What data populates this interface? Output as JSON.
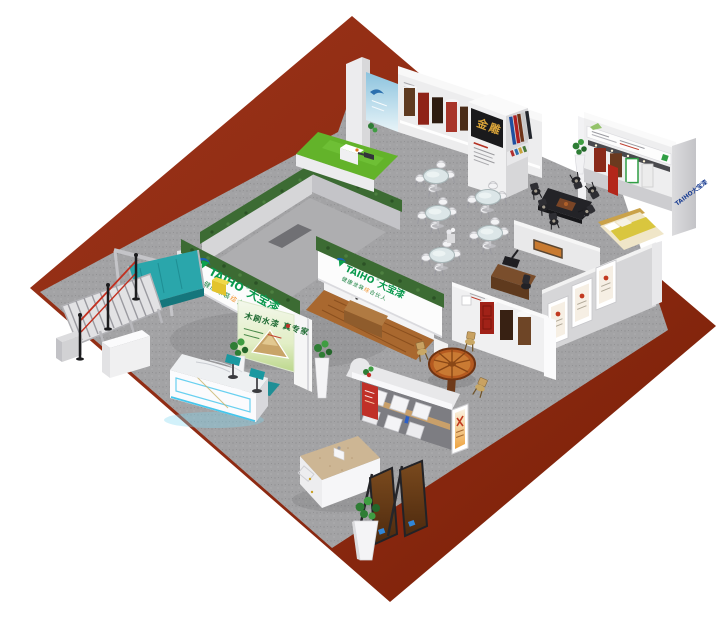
{
  "scene": {
    "type": "3d-exhibition-booth-render",
    "background": "#ffffff"
  },
  "colors": {
    "platform_maroon": "#8e2a12",
    "carpet_gray": "#a3a3a5",
    "hedge_green": "#3c6b33",
    "grass_green": "#63b32a",
    "belt_teal": "#2aa6ab",
    "brand_green": "#0a9a4e",
    "brand_blue": "#1c3f93",
    "sign_gold": "#d9a43a"
  },
  "branding": {
    "logo_en": "TAIHO",
    "logo_reg": "®",
    "logo_cn": "大宝漆",
    "slogan_prefix": "健康涂装",
    "slogan_accent": "综",
    "slogan_suffix": "合伙人",
    "poster_calligraphy": "木刷水漆 真专家",
    "gold_sign": "金雕",
    "side_wall_logo": "TAIHO大宝漆"
  }
}
